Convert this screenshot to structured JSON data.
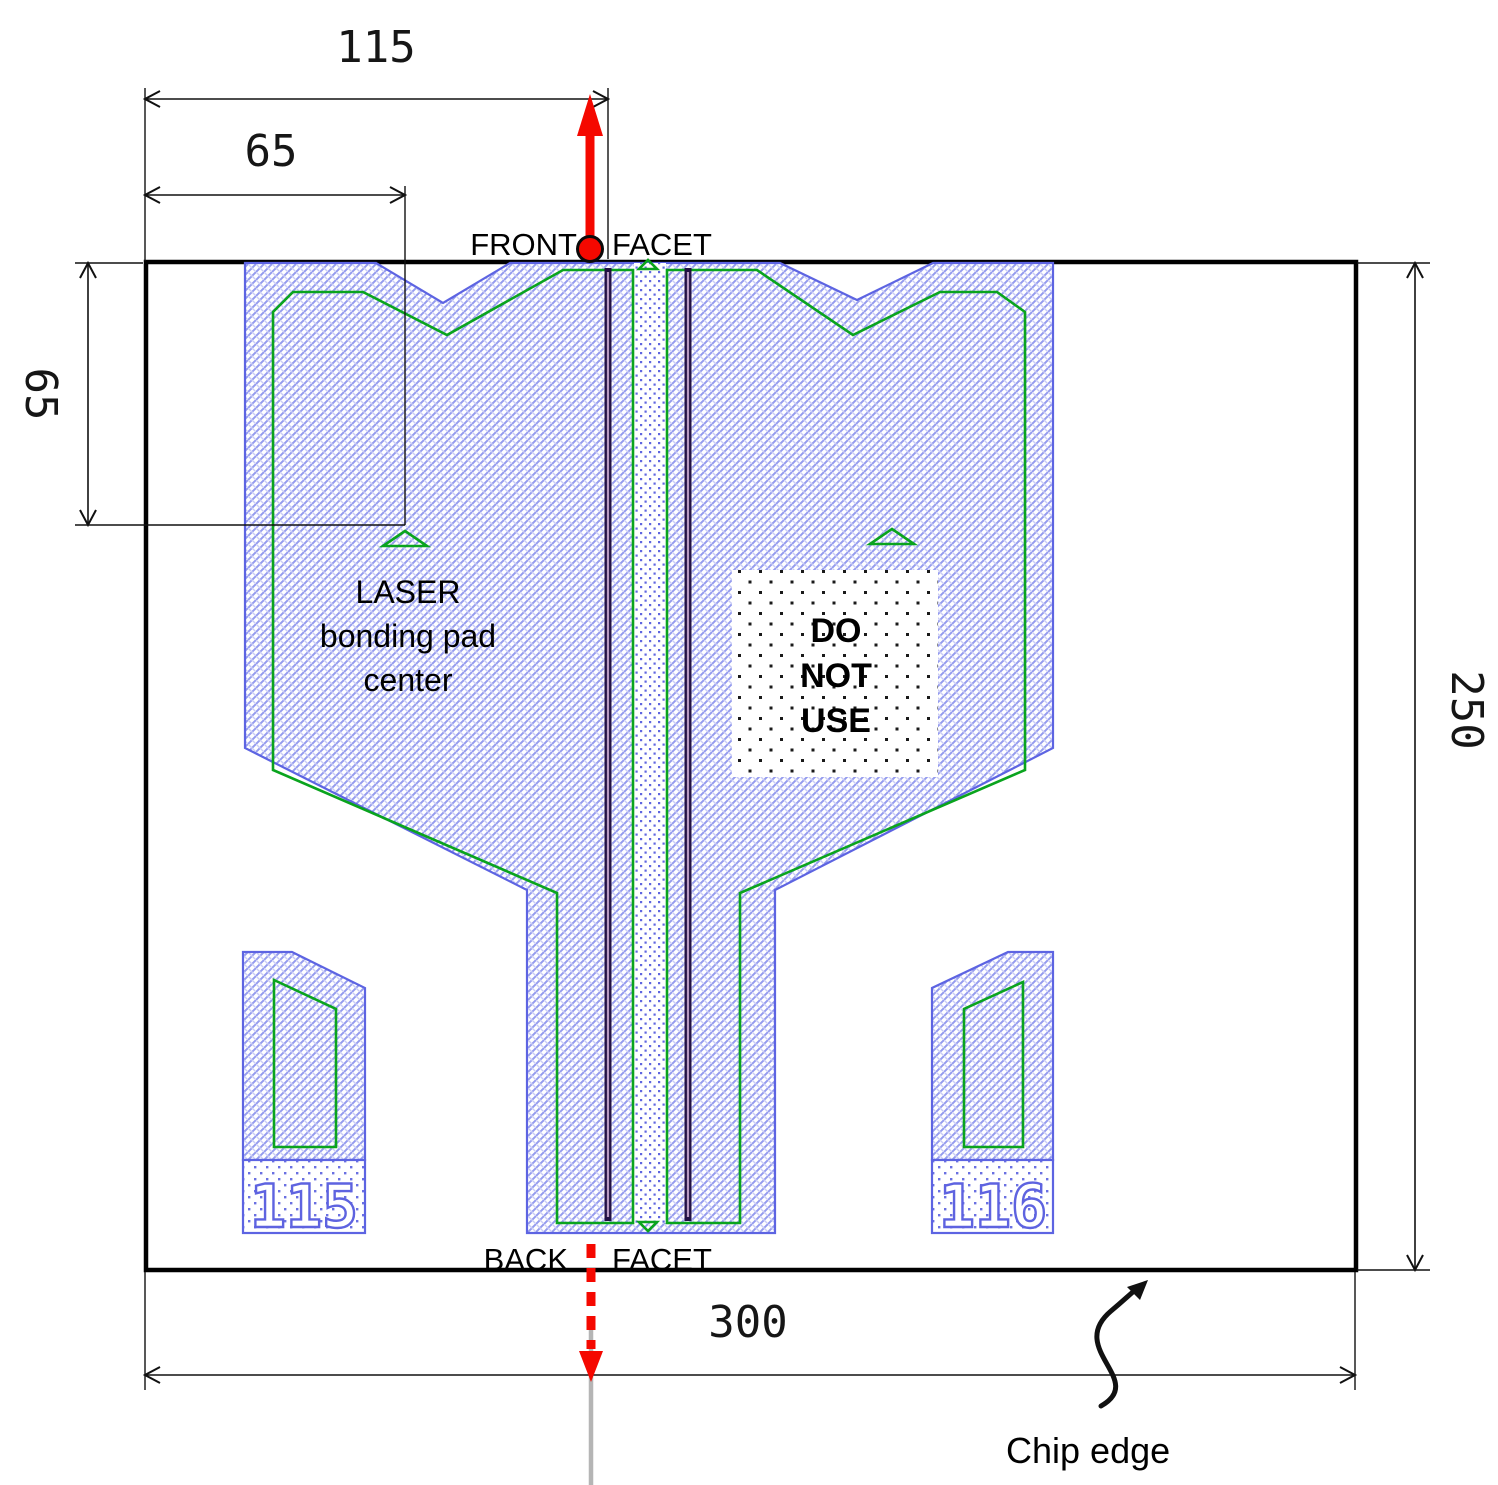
{
  "dimensions": {
    "facet_offset": "115",
    "pad_center_x": "65",
    "pad_center_y": "65",
    "chip_width": "300",
    "chip_height": "250"
  },
  "labels": {
    "front_facet_left": "FRONT",
    "front_facet_right": "FACET",
    "back_facet_left": "BACK",
    "back_facet_right": "FACET",
    "laser_pad_line1": "LASER",
    "laser_pad_line2": "bonding pad",
    "laser_pad_line3": "center",
    "do_not_use_line1": "DO",
    "do_not_use_line2": "NOT",
    "do_not_use_line3": "USE",
    "chip_edge": "Chip edge",
    "pad_left_id": "115",
    "pad_right_id": "116"
  },
  "colors": {
    "beam_red": "#f50800",
    "outline_green": "#0aa41e",
    "metal_blue": "#5d64e2",
    "pink_hatch": "#ec8f8f",
    "beam_gray": "#b5b5b5",
    "line_black": "#111111"
  }
}
